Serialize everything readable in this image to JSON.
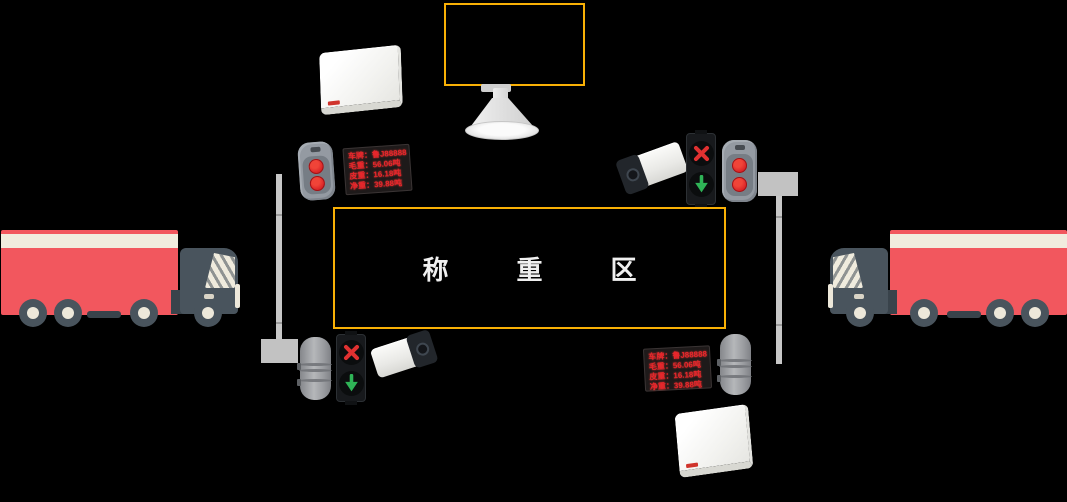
{
  "zone": {
    "label": "称重区"
  },
  "led_display": {
    "lines": [
      "车牌：鲁J88888",
      "毛重：56.06吨",
      "皮重：16.18吨",
      "净重：39.88吨"
    ]
  },
  "colors": {
    "background": "#000000",
    "accent_orange": "#F9B005",
    "led_text_red": "#E8262C",
    "truck_red": "#F2575E",
    "truck_stripe_cream": "#F1ECDE",
    "signal_red": "#E03131",
    "signal_green": "#2FB457",
    "device_grey": "#949AA2"
  },
  "icons": {
    "stop": "red-x-icon",
    "go": "green-down-arrow-icon",
    "speaker": "horn-speaker",
    "antenna": "rfid-antenna-panel",
    "camera": "lpr-camera",
    "sensor": "infrared-cylinder-sensor",
    "lamp": "dual-red-lamp",
    "display": "led-weight-display",
    "truck": "cargo-truck"
  }
}
